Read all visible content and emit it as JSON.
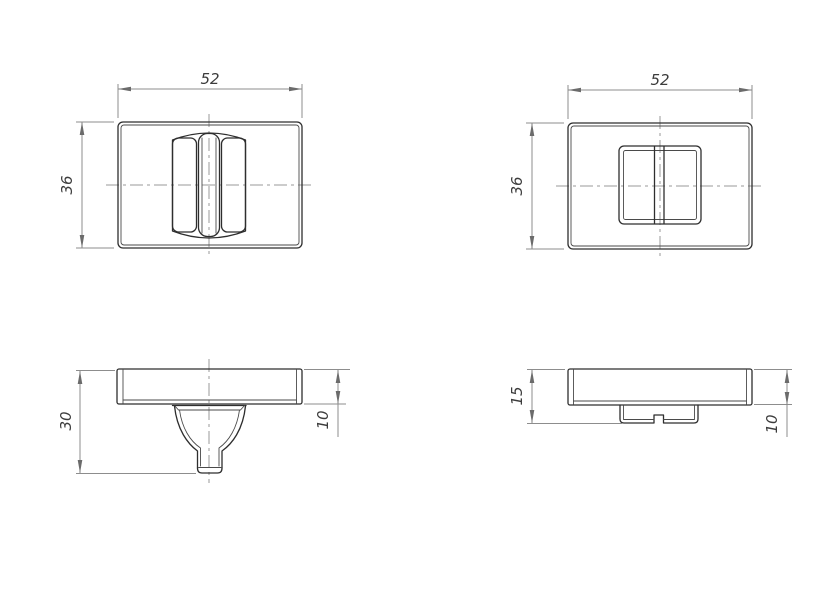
{
  "drawing": {
    "background_color": "#ffffff",
    "object_line_color": "#2e2e2e",
    "thin_line_color": "#8d8d8d",
    "center_line_color": "#9a9a9a",
    "text_color": "#3c3c3c",
    "views": {
      "thumbturn_front": {
        "dim_width": "52",
        "dim_height": "36"
      },
      "release_front": {
        "dim_width": "52",
        "dim_height": "36"
      },
      "thumbturn_side": {
        "dim_overall": "30",
        "dim_plate": "10"
      },
      "release_side": {
        "dim_overall": "15",
        "dim_plate": "10"
      }
    }
  }
}
